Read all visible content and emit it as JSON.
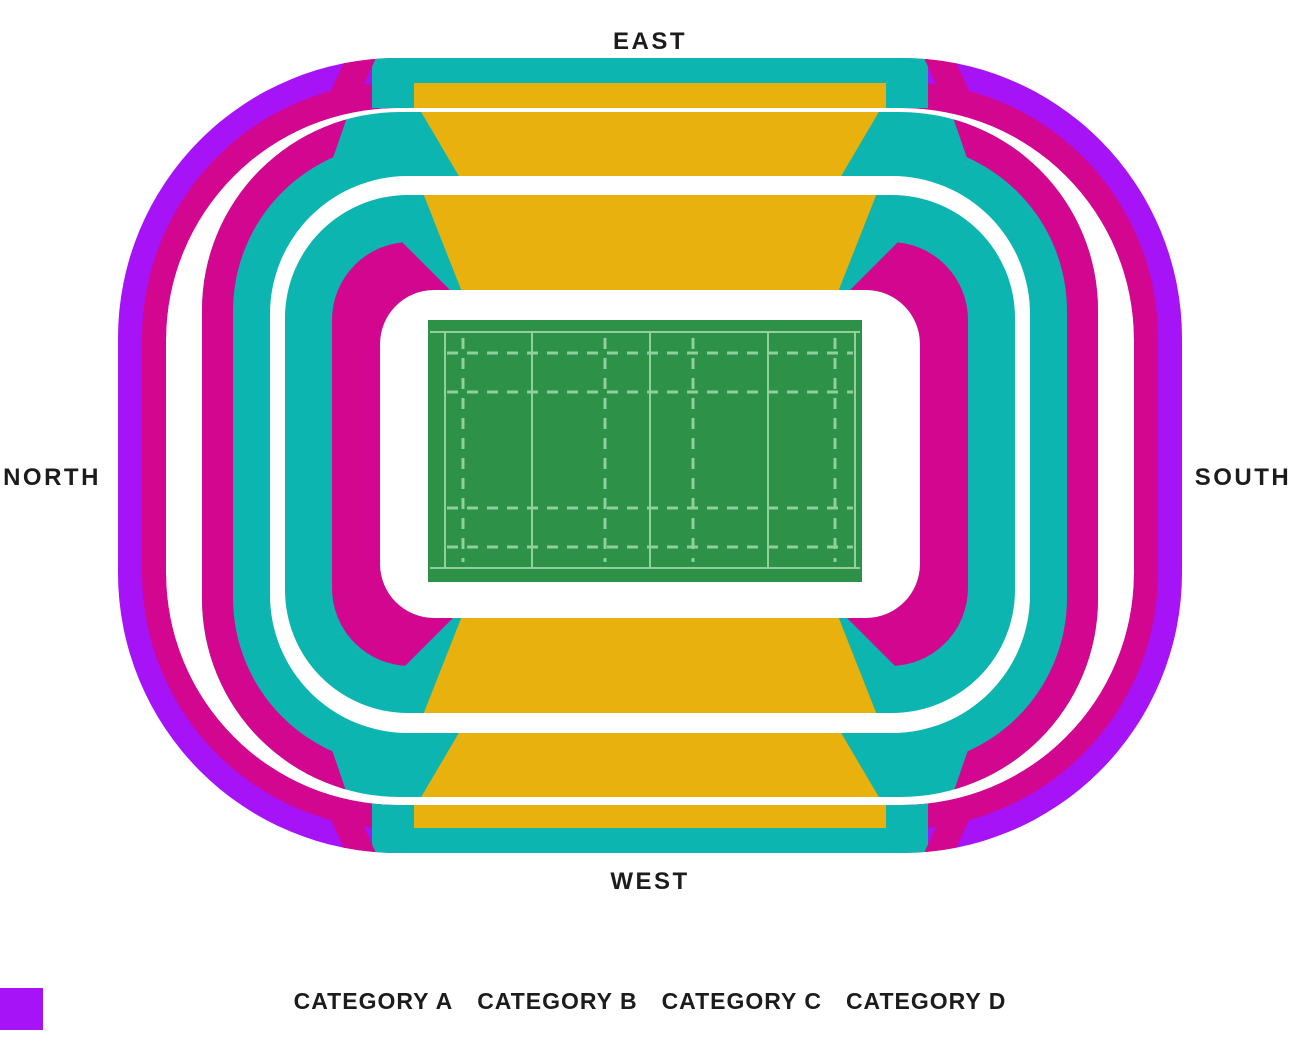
{
  "page": {
    "background": "#ffffff"
  },
  "compass": {
    "east": "EAST",
    "west": "WEST",
    "north": "NORTH",
    "south": "SOUTH"
  },
  "colors": {
    "category_a": "#E8B10E",
    "category_b": "#0DB5B0",
    "category_c": "#D3068F",
    "category_d": "#A613F7",
    "pitch_green": "#2E9148",
    "pitch_line": "#8FD09B",
    "label_text": "#1c1c1c"
  },
  "legend": {
    "items": [
      {
        "label": "CATEGORY A",
        "category": "A",
        "color": "#E8B10E"
      },
      {
        "label": "CATEGORY B",
        "category": "B",
        "color": "#0DB5B0"
      },
      {
        "label": "CATEGORY C",
        "category": "C",
        "color": "#D3068F"
      },
      {
        "label": "CATEGORY D",
        "category": "D",
        "color": "#A613F7"
      }
    ]
  },
  "stadium": {
    "sections": [
      {
        "name": "east-upper-rim",
        "category": "B"
      },
      {
        "name": "east-upper",
        "category": "A"
      },
      {
        "name": "east-middle",
        "category": "A"
      },
      {
        "name": "east-lower",
        "category": "A"
      },
      {
        "name": "west-upper-rim",
        "category": "B"
      },
      {
        "name": "west-upper",
        "category": "A"
      },
      {
        "name": "west-middle",
        "category": "A"
      },
      {
        "name": "west-lower",
        "category": "A"
      },
      {
        "name": "north-south-upper-outer",
        "category": "D"
      },
      {
        "name": "north-south-upper-inner",
        "category": "C"
      },
      {
        "name": "north-south-middle-outer",
        "category": "C"
      },
      {
        "name": "north-south-middle-inner",
        "category": "B"
      },
      {
        "name": "north-south-lower",
        "category": "B"
      },
      {
        "name": "north-south-lower-pitchside",
        "category": "C"
      }
    ]
  }
}
